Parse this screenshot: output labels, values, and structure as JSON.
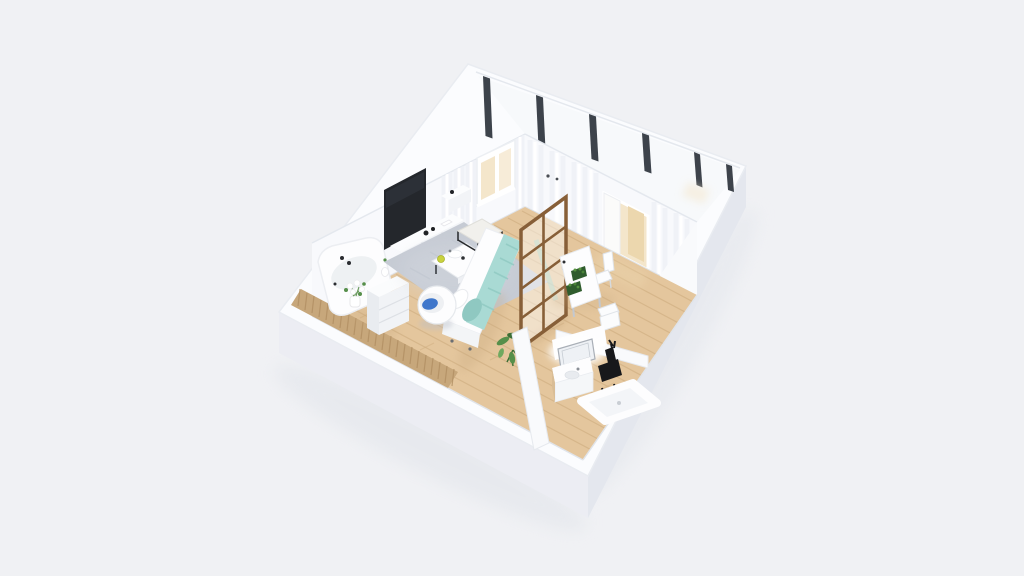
{
  "scene": {
    "kind": "isometric-3d-floorplan-render",
    "rooms": [
      "living-area",
      "sleeping-area",
      "dining-area",
      "bathroom",
      "glazed-balcony"
    ],
    "objects": [
      "tv-screen",
      "media-console",
      "small-cabinet",
      "corner-bathtub",
      "flower-bouquet",
      "dresser",
      "tile-accent-strip",
      "area-rug",
      "coffee-table",
      "ottoman",
      "ball-chair",
      "daybed-sofa",
      "teal-blanket",
      "glass-room-divider",
      "dining-table",
      "planter-boxes",
      "dining-chairs",
      "floor-plant",
      "balcony-door",
      "window",
      "window-mullions",
      "bathroom-vanity",
      "led-mirror",
      "black-plant-stand",
      "bathtub",
      "curtains",
      "wood-floor"
    ]
  },
  "colors": {
    "background": "#f0f1f4",
    "wall_top": "#fbfcfe",
    "wall_face_sw": "#ecedf3",
    "wall_face_se": "#e4e7ee",
    "wall_inner": "#f8f9fc",
    "balcony": "#f7f9fb",
    "wood_floor": "#e4c69d",
    "plank_line": "#d2b186",
    "tile_strip": "#c7a77b",
    "tile_joint": "#b08f63",
    "rug": "#c6cbd4",
    "rug_light": "#d5d9e0",
    "teal_blanket": "#a9dad4",
    "teal_shadow": "#8fc8c1",
    "ball_chair_blue": "#4077cb",
    "divider_brown": "#875f38",
    "tv_dark": "#24272c",
    "mullion_dark": "#3d434b",
    "warm_light": "#f4e6cb",
    "warm_deep": "#ecd7ae",
    "plant_green": "#568f4a",
    "plant_dark": "#3c6e35",
    "fixture_black": "#17181b",
    "white": "#fdfdfe",
    "shadow_warm": "#c7a87e",
    "shadow_cool": "#b9bec8"
  }
}
